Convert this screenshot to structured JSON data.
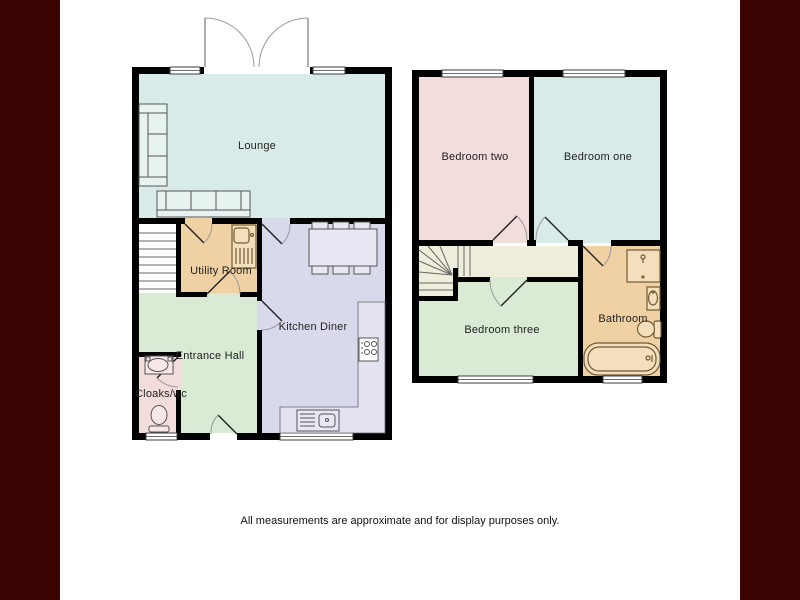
{
  "colors": {
    "frame": "#3b0202",
    "wall": "#000000",
    "cyan_room": "#d8ebe9",
    "pink_room": "#f3dcdc",
    "tan_room": "#f0d1a3",
    "green_room": "#d9ebd5",
    "lavender_room": "#d9d9ec",
    "cream_room": "#efeddc",
    "white": "#ffffff",
    "counter": "#e2e2f1",
    "cyan_furniture": "#e6f3f1",
    "lavender_furniture": "#e8e8f5",
    "pink_furniture": "#f7e7e7",
    "tan_furniture": "#f4dfbc"
  },
  "ground_floor": {
    "rooms": {
      "lounge": "Lounge",
      "utility": "Utility Room",
      "kitchen": "Kitchen Diner",
      "hall": "Entrance Hall",
      "cloaks": "Cloaks/wc"
    }
  },
  "first_floor": {
    "rooms": {
      "bedroom_two": "Bedroom two",
      "bedroom_one": "Bedroom one",
      "bedroom_three": "Bedroom three",
      "bathroom": "Bathroom"
    }
  },
  "footer": {
    "disclaimer": "All measurements are approximate and for display purposes only."
  }
}
